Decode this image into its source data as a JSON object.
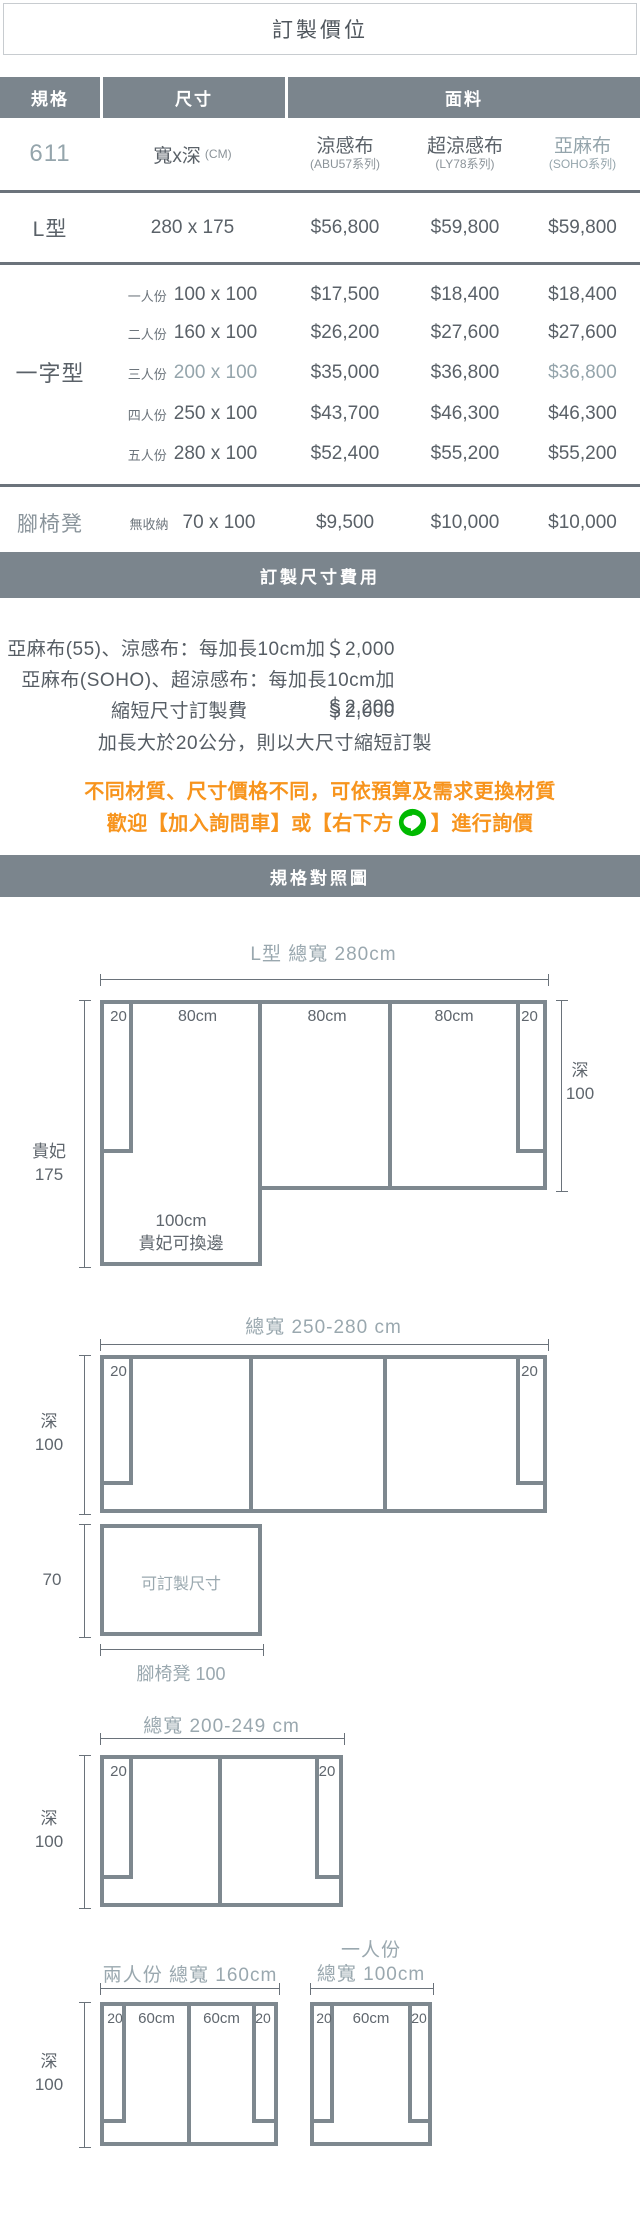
{
  "title": "訂製價位",
  "table": {
    "col_headers": {
      "spec": "規格",
      "size": "尺寸",
      "fabric": "面料"
    },
    "model": "611",
    "size_unit": {
      "main": "寬x深",
      "sub": "(CM)"
    },
    "fabrics": [
      {
        "name": "涼感布",
        "series": "(ABU57系列)"
      },
      {
        "name": "超涼感布",
        "series": "(LY78系列)"
      },
      {
        "name": "亞麻布",
        "series": "(SOHO系列)"
      }
    ],
    "sections": [
      {
        "label": "L型",
        "rows": [
          {
            "prefix": "",
            "size": "280 x 175",
            "prices": [
              "$56,800",
              "$59,800",
              "$59,800"
            ]
          }
        ]
      },
      {
        "label": "一字型",
        "rows": [
          {
            "prefix": "一人份",
            "size": "100 x 100",
            "prices": [
              "$17,500",
              "$18,400",
              "$18,400"
            ]
          },
          {
            "prefix": "二人份",
            "size": "160 x 100",
            "prices": [
              "$26,200",
              "$27,600",
              "$27,600"
            ]
          },
          {
            "prefix": "三人份",
            "size": "200 x 100",
            "prices": [
              "$35,000",
              "$36,800",
              "$36,800"
            ]
          },
          {
            "prefix": "四人份",
            "size": "250 x 100",
            "prices": [
              "$43,700",
              "$46,300",
              "$46,300"
            ]
          },
          {
            "prefix": "五人份",
            "size": "280 x 100",
            "prices": [
              "$52,400",
              "$55,200",
              "$55,200"
            ]
          }
        ]
      },
      {
        "label": "腳椅凳",
        "rows": [
          {
            "prefix": "無收納",
            "size": "70 x 100",
            "prices": [
              "$9,500",
              "$10,000",
              "$10,000"
            ]
          }
        ]
      }
    ]
  },
  "fee": {
    "band": "訂製尺寸費用",
    "line1": "亞麻布(55)、涼感布：每加長10cm加＄2,000",
    "line2": "亞麻布(SOHO)、超涼感布：每加長10cm加＄2,200",
    "short_label": "縮短尺寸訂製費",
    "short_price": "＄2,000",
    "note": "加長大於20公分，則以大尺寸縮短訂製"
  },
  "promo": {
    "line1": "不同材質、尺寸價格不同，可依預算及需求更換材質",
    "line2_pre": "歡迎【加入詢問車】或【右下方",
    "line2_post": "】進行詢價",
    "icon": "line-app-icon"
  },
  "compare": {
    "band": "規格對照圖",
    "labels": {
      "arm": "20",
      "depth": "深",
      "depth_val": "100",
      "seat80": "80cm",
      "seat60": "60cm"
    },
    "l_type": {
      "title": "L型 總寬 280cm",
      "left_1": "貴妃",
      "left_2": "175",
      "chaise_1": "100cm",
      "chaise_2": "貴妃可換邊"
    },
    "wide": {
      "title": "總寬 250-280 cm"
    },
    "stool": {
      "text": "可訂製尺寸",
      "left": "70",
      "bottom": "腳椅凳 100"
    },
    "mid": {
      "title": "總寬 200-249 cm"
    },
    "two": {
      "title": "兩人份 總寬 160cm"
    },
    "one": {
      "title_1": "一人份",
      "title_2": "總寬 100cm"
    }
  },
  "colors": {
    "band_gray": "#7b858d",
    "accent": "#95a5ac",
    "orange": "#f7941d",
    "line_green": "#00b900",
    "diagram_border": "#7e888f"
  }
}
